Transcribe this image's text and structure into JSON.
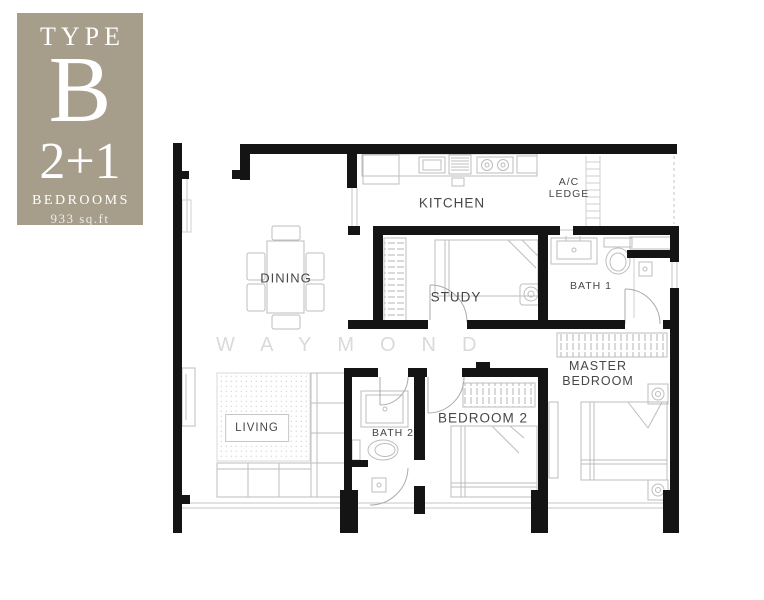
{
  "badge": {
    "type_label": "TYPE",
    "type_letter": "B",
    "configuration": "2+1",
    "bedrooms_label": "BEDROOMS",
    "area": "933 sq.ft",
    "bg_color": "#a79d8b",
    "text_color": "#ffffff"
  },
  "watermark": {
    "text": "WAYMOND"
  },
  "plan": {
    "labels": {
      "kitchen": "KITCHEN",
      "ac_ledge_line1": "A/C",
      "ac_ledge_line2": "LEDGE",
      "dining": "DINING",
      "study": "STUDY",
      "bath1": "BATH 1",
      "master_line1": "MASTER",
      "master_line2": "BEDROOM",
      "bedroom2": "BEDROOM 2",
      "bath2": "BATH 2",
      "living": "LIVING"
    },
    "colors": {
      "wall": "#141414",
      "furniture_line": "#bdbdbd",
      "label_text": "#474747",
      "watermark": "#dadada"
    }
  }
}
